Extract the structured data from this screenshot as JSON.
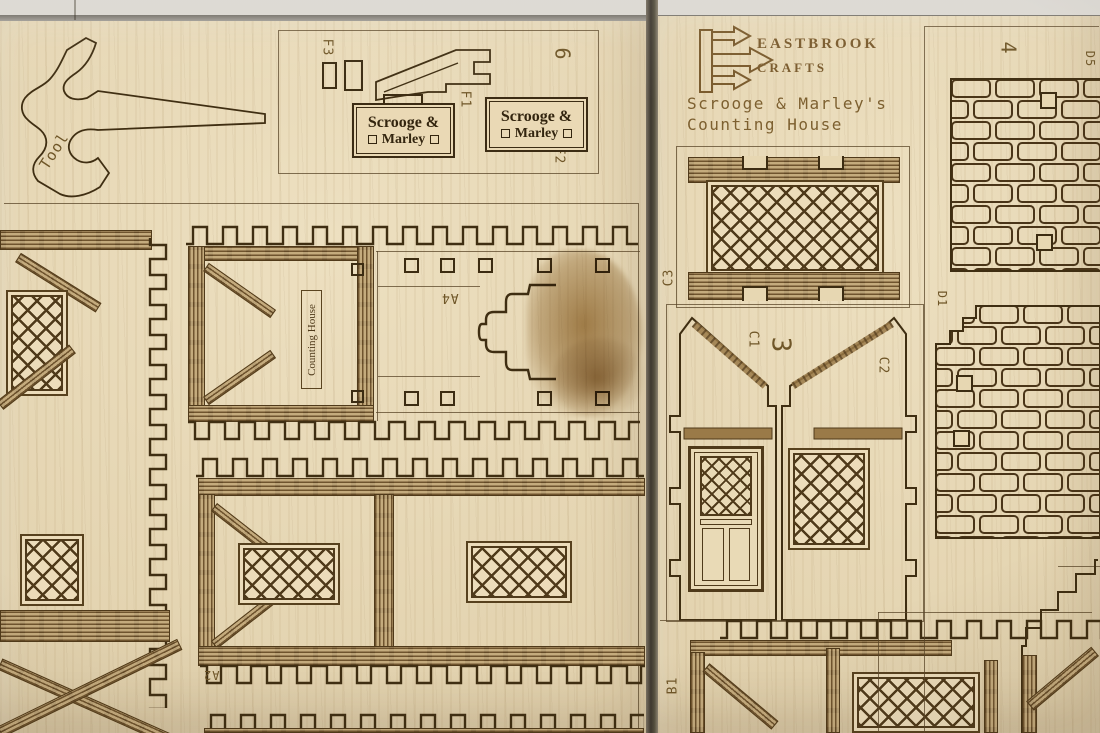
{
  "scene": {
    "description": "Photo of two laser-cut plywood model-kit sheets for a Christmas village building",
    "colors": {
      "wood": "#e7d7b2",
      "engraving": "#4f3a1a",
      "timber": "#a1804e",
      "stain": "#b2905c",
      "background": "#dbd8d2",
      "seam": "#3e382f"
    }
  },
  "left_sheet": {
    "tool": {
      "label": "Tool"
    },
    "sprue": {
      "f3": "F3",
      "f1": "F1",
      "f2": "F2",
      "sheet_no": "6",
      "signs": [
        {
          "line1": "Scrooge &",
          "line2": "Marley"
        },
        {
          "line1": "Scrooge &",
          "line2": "Marley"
        }
      ]
    },
    "pieces": {
      "counting_house": "Counting House",
      "a4": "A4",
      "a2": "A2"
    }
  },
  "right_sheet": {
    "brand": {
      "line1": "EASTBROOK",
      "line2": "CRAFTS"
    },
    "title": {
      "line1": "Scrooge & Marley's",
      "line2": "Counting House"
    },
    "pieces": {
      "c3": "C3",
      "c1": "C1",
      "gable_no": "3",
      "c2": "C2",
      "b1": "B1",
      "col_no": "4",
      "d5": "D5",
      "d1": "D1"
    }
  }
}
